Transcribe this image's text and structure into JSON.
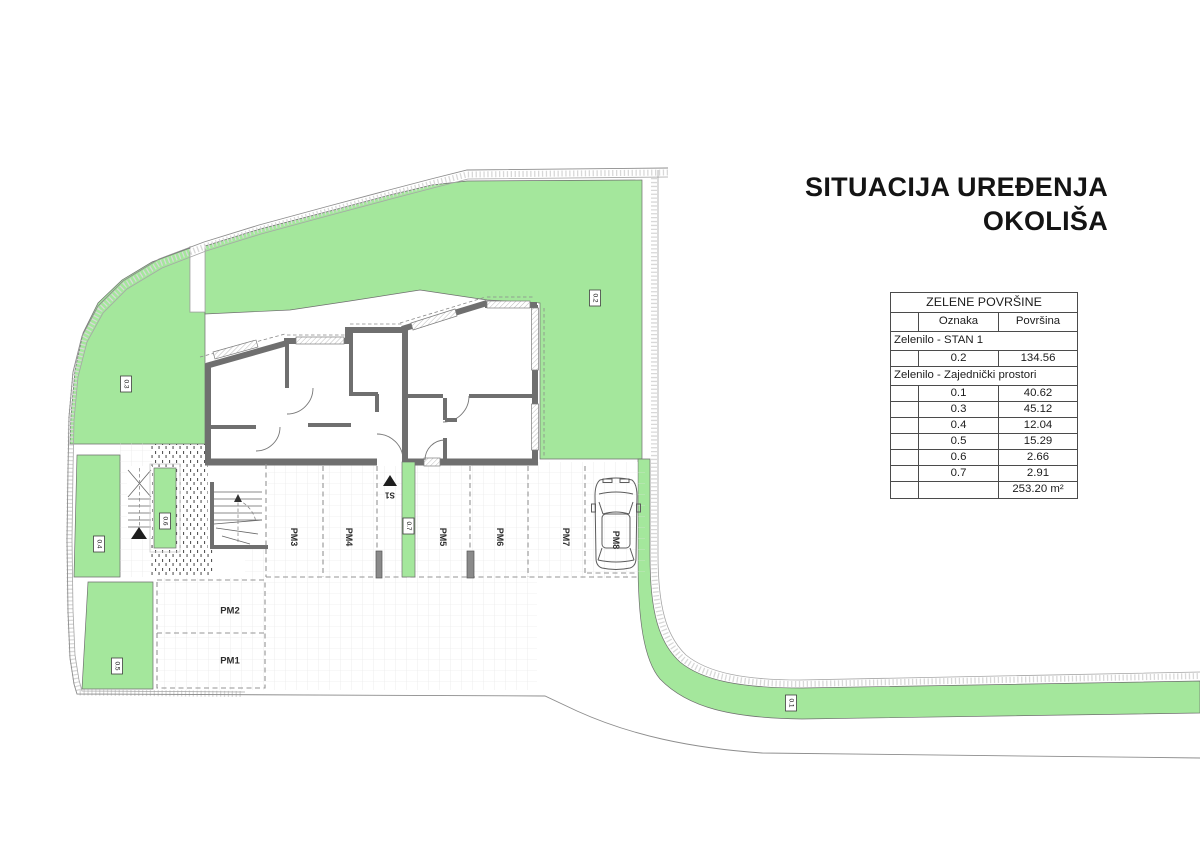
{
  "heading": {
    "line1": "SITUACIJA UREĐENJA",
    "line2": "OKOLIŠA"
  },
  "legend_table": {
    "rows": [
      {
        "type": "title",
        "text": "ZELENE POVRŠINE"
      },
      {
        "type": "header",
        "cells": [
          "",
          "Oznaka",
          "Površina"
        ]
      },
      {
        "type": "section",
        "text": "Zelenilo - STAN 1"
      },
      {
        "type": "data",
        "oznaka": "0.2",
        "povrsina": "134.56"
      },
      {
        "type": "section",
        "text": "Zelenilo - Zajednički prostori"
      },
      {
        "type": "data",
        "oznaka": "0.1",
        "povrsina": "40.62"
      },
      {
        "type": "data",
        "oznaka": "0.3",
        "povrsina": "45.12"
      },
      {
        "type": "data",
        "oznaka": "0.4",
        "povrsina": "12.04"
      },
      {
        "type": "data",
        "oznaka": "0.5",
        "povrsina": "15.29"
      },
      {
        "type": "data",
        "oznaka": "0.6",
        "povrsina": "2.66"
      },
      {
        "type": "data",
        "oznaka": "0.7",
        "povrsina": "2.91"
      },
      {
        "type": "total",
        "text": "253.20 m²"
      }
    ]
  },
  "plan": {
    "area_labels": {
      "a01": "0.1",
      "a02": "0.2",
      "a03": "0.3",
      "a04": "0.4",
      "a05": "0.5",
      "a06": "0.6",
      "a07": "0.7"
    },
    "parking_labels": {
      "pm1": "PM1",
      "pm2": "PM2",
      "pm3": "PM3",
      "pm4": "PM4",
      "pm5": "PM5",
      "pm6": "PM6",
      "pm7": "PM7",
      "pm8": "PM8"
    },
    "stair_ref": "S1",
    "colors": {
      "green": "#a4e79c",
      "wall": "#6f6f6f",
      "line": "#9a9a9a"
    }
  }
}
